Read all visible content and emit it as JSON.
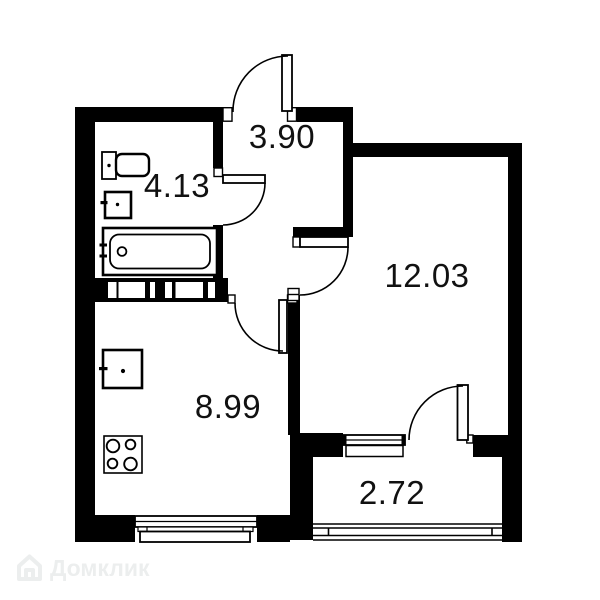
{
  "plan": {
    "type": "apartment-floor-plan",
    "rooms": [
      {
        "id": "hallway",
        "area_label": "3.90"
      },
      {
        "id": "bathroom",
        "area_label": "4.13"
      },
      {
        "id": "living-room",
        "area_label": "12.03"
      },
      {
        "id": "kitchen",
        "area_label": "8.99"
      },
      {
        "id": "balcony",
        "area_label": "2.72"
      }
    ],
    "fixtures": [
      "entrance-door",
      "bathroom-door",
      "kitchen-door",
      "living-room-door",
      "balcony-door",
      "toilet",
      "bathroom-sink",
      "bathtub",
      "ventilation-shaft",
      "kitchen-sink",
      "stove",
      "kitchen-window",
      "balcony-window",
      "balcony-glazing"
    ],
    "watermark": {
      "text": "Домклик"
    },
    "colors": {
      "wall": "#000000",
      "background": "#ffffff",
      "label_text": "#111111",
      "watermark": "#eceeee"
    }
  }
}
